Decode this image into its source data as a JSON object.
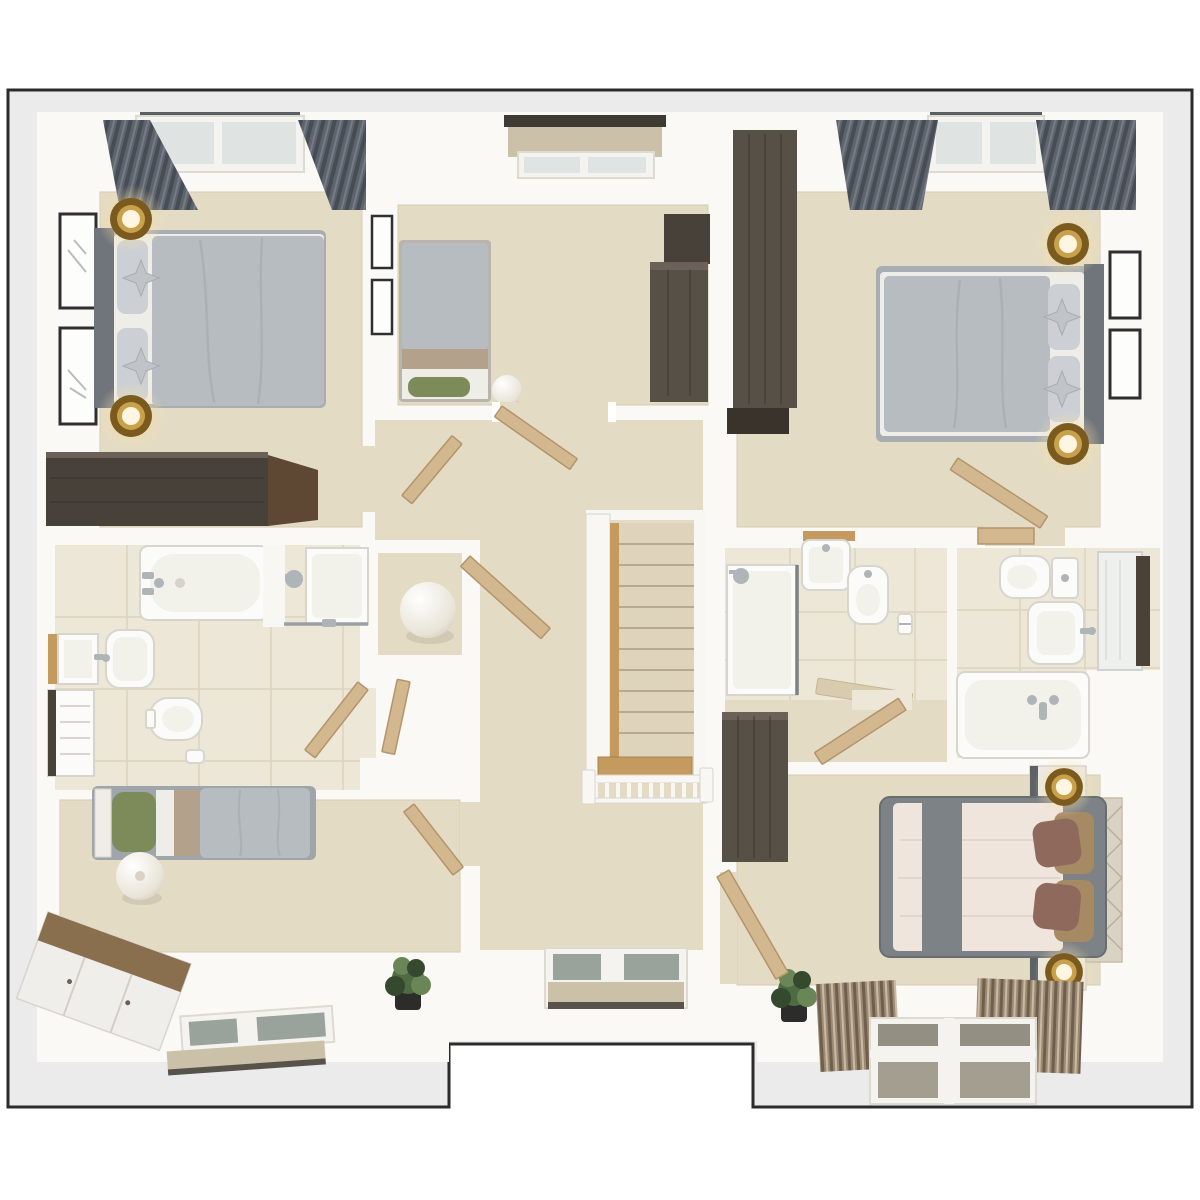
{
  "scene": {
    "type": "3d-floor-plan-render",
    "view": "top-down",
    "description": "Photorealistic top-down 3D render of an upper storey floor plan with four bedrooms, three bathrooms, a landing and a staircase",
    "footprint": "rectangle with recessed notch at bottom centre",
    "rooms": [
      {
        "id": "bedroom-top-left",
        "furniture": [
          "double-bed-gray-duvet",
          "dark-gray-headboard",
          "two-star-cushions",
          "two-brass-bedside-lamps",
          "two-black-picture-frames",
          "gray-curtains",
          "roof-window",
          "dark-wood-dresser"
        ]
      },
      {
        "id": "bedroom-top-middle",
        "furniture": [
          "single-bed-gray-duvet",
          "green-accent-pillow",
          "tan-folded-blanket",
          "white-sphere-lamp",
          "two-picture-frames",
          "roller-blind-window",
          "dark-wood-wardrobe",
          "dark-wood-chest"
        ]
      },
      {
        "id": "bedroom-top-right",
        "furniture": [
          "double-bed-gray-duvet",
          "dark-gray-headboard",
          "two-star-cushions",
          "two-brass-bedside-lamps",
          "two-black-picture-frames",
          "gray-curtains",
          "roof-window",
          "tall-dark-wood-wardrobe",
          "open-door"
        ]
      },
      {
        "id": "bathroom-left",
        "furniture": [
          "bathtub",
          "shower-enclosure",
          "square-basin",
          "rounded-basin",
          "toilet",
          "towel-panel",
          "tiled-floor",
          "open-door"
        ]
      },
      {
        "id": "landing-hallway",
        "furniture": [
          "beige-carpet",
          "storage-niche-with-sphere-lamp",
          "several-open-doors",
          "roof-window-with-blind"
        ]
      },
      {
        "id": "staircase",
        "furniture": [
          "carpeted-treads",
          "oak-edge-strip",
          "oak-winder-landing",
          "white-spindle-balustrade",
          "newel-posts"
        ]
      },
      {
        "id": "shower-room-right",
        "furniture": [
          "shower-enclosure",
          "wall-basin-with-wood-shelf",
          "wall-hung-toilet",
          "toilet-roll-holder",
          "wooden-bath-mat",
          "tiled-floor",
          "open-door"
        ]
      },
      {
        "id": "bathroom-right",
        "furniture": [
          "toilet-with-cistern",
          "basin",
          "mirror-cabinet",
          "bathtub-with-chrome-taps",
          "tiled-floor",
          "door-against-wall"
        ]
      },
      {
        "id": "bedroom-bottom-left",
        "furniture": [
          "single-bed-gray-duvet",
          "green-pillow",
          "white-headboard",
          "paper-lantern-lamp",
          "wood-top-white-sideboard",
          "roof-window-with-blind",
          "potted-plant",
          "open-door"
        ]
      },
      {
        "id": "bedroom-bottom-right-master",
        "furniture": [
          "double-bed-cream-duvet",
          "gray-bed-runner",
          "brown-and-tan-pillows",
          "diamond-pattern-headboard",
          "two-nightstands-with-brass-lamps",
          "pinstripe-curtains",
          "roof-window",
          "dark-wood-wardrobe",
          "potted-plant",
          "open-door"
        ]
      }
    ]
  },
  "palette": {
    "outline": "#2b2b2b",
    "band": "#ebebeb",
    "house": "#faf9f6",
    "carpet": "#e4dbc4",
    "carpet_line": "#d5ccb4",
    "tile": "#ece7d6",
    "grout": "#d9d2bd",
    "duvet": "#b7bcc1",
    "duvet_dark": "#a8adb3",
    "sheet": "#efede8",
    "headboard": "#70757b",
    "pillow": "#ccd0d4",
    "pillow_star": "#c0c4c9",
    "curtain": "#5d646d",
    "curtain_fold": "#474d55",
    "wood_dark": "#47413a",
    "wood_dark2": "#575047",
    "wood_plank": "#36312b",
    "wood_brown": "#5e4833",
    "wardrobe_top": "#6b6158",
    "oak": "#c49a5f",
    "door_wood": "#d3b78f",
    "door_edge": "#b2956c",
    "blind": "#cbc0a8",
    "blind_bar": "#57534a",
    "pane": "#9aa39b",
    "pane_b": "#948f83",
    "pane_c": "#a49e90",
    "glass": "#dfe4e2",
    "frame_white": "#f4f3ef",
    "brass_dark": "#7a5a1d",
    "brass": "#c9a04b",
    "green": "#7d8b5a",
    "tan": "#b3a18c",
    "master_duvet": "#f0e5dd",
    "throw": "#7d8287",
    "pillow_brown": "#8f6a5c",
    "pillow_tan": "#a58a64",
    "headboard_panel": "#d9d3c3",
    "lattice": "#b9b097",
    "fixture": "#fbfbf9",
    "fixture_line": "#d7d5cd",
    "fixture_inner": "#f2f1ea",
    "chrome": "#aeb4b8",
    "plant": "#4e6b42",
    "plant_light": "#6a8657",
    "plant_dark": "#35492e",
    "pot": "#2c2c2a",
    "stairs": "#ded4bc",
    "stair_line": "#b6ab90",
    "rail": "#f8f7f4",
    "rail_line": "#d9d6cc",
    "frame_black": "#2f2f2f",
    "sketch": "#b9bdbd"
  }
}
